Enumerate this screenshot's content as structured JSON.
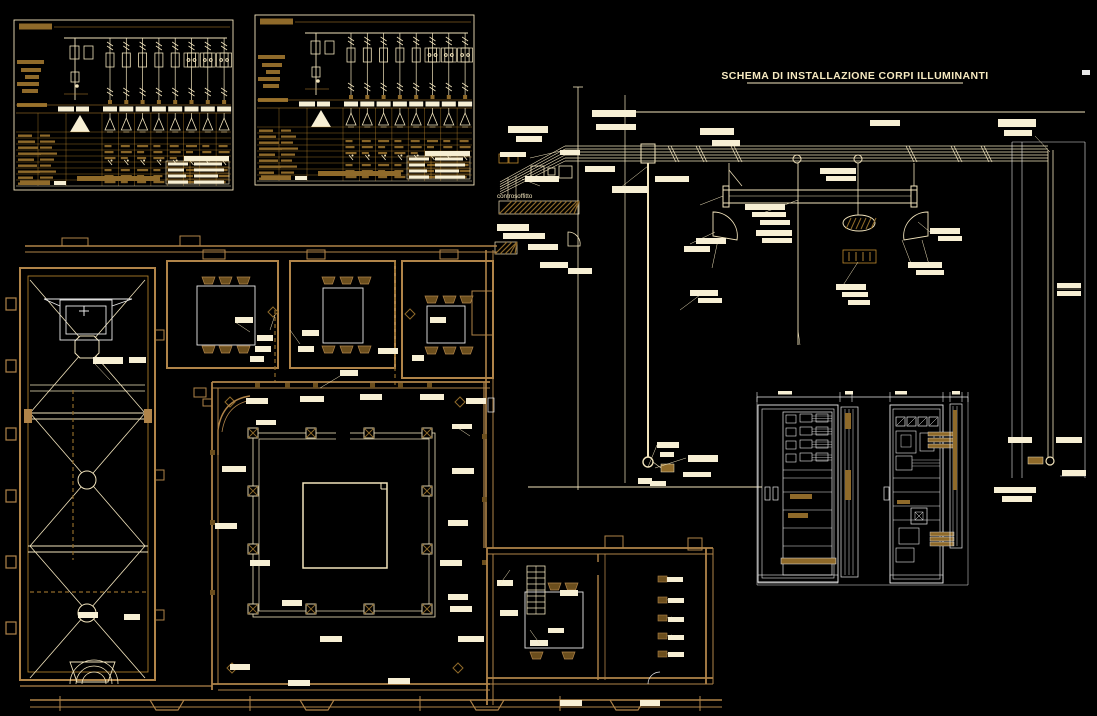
{
  "drawing": {
    "type": "electrical CAD drawing",
    "background": "#000000"
  },
  "texts": {
    "schema_title": "SCHEMA DI INSTALLAZIONE CORPI ILLUMINANTI",
    "ceiling_label": "controsoffitto"
  },
  "colors": {
    "bright": "#F2E4BC",
    "cream": "#F7EFD4",
    "amber": "#C08A2E",
    "wall": "#B08449",
    "tan": "#8F6A2A",
    "dark_tan": "#6B4E1D",
    "white": "#E9E9E9",
    "bg": "#000000"
  },
  "panels": {
    "count": 2,
    "branch_count": 8,
    "wide_branch_count": 3,
    "grid_rows": 9
  },
  "cabinets": {
    "count": 2,
    "meter_modules": 4
  },
  "floor_plan": {
    "church_truss_bays": 3,
    "cloister_columns_per_side": 4,
    "top_rooms": 3
  }
}
